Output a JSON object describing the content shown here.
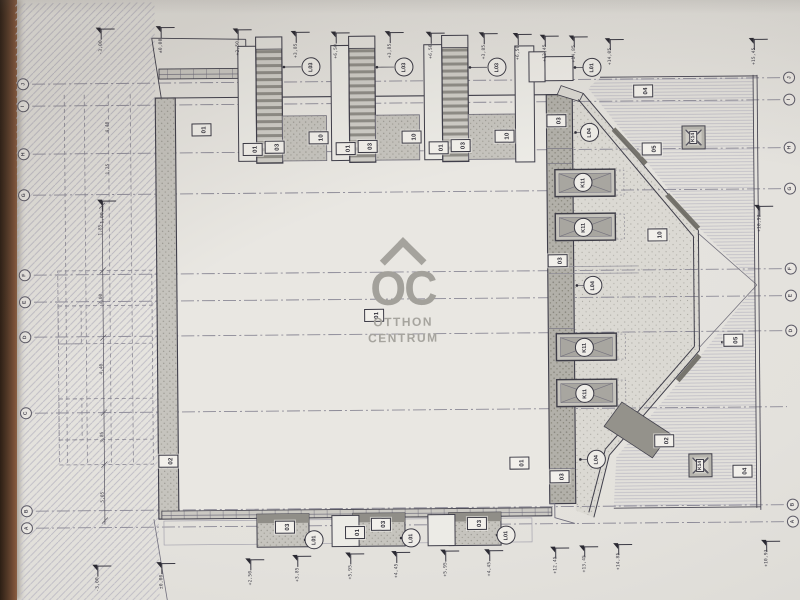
{
  "colors": {
    "paper": "#e3e1dc",
    "ink": "#3f3e4a",
    "ink_light": "#8b8996",
    "watermark": "#a3a19b",
    "table_edge": "#4a3323"
  },
  "watermark": {
    "logo": "OC",
    "line1": "OTTHON",
    "line2": "CENTRUM"
  },
  "plan_labels": [
    {
      "k": "bub",
      "t": "J",
      "x": 25,
      "y": 81
    },
    {
      "k": "bub",
      "t": "I",
      "x": 25,
      "y": 103
    },
    {
      "k": "bub",
      "t": "H",
      "x": 25,
      "y": 151
    },
    {
      "k": "bub",
      "t": "G",
      "x": 25,
      "y": 192
    },
    {
      "k": "bub",
      "t": "F",
      "x": 25,
      "y": 272
    },
    {
      "k": "bub",
      "t": "E",
      "x": 25,
      "y": 299
    },
    {
      "k": "bub",
      "t": "D",
      "x": 25,
      "y": 334
    },
    {
      "k": "bub",
      "t": "C",
      "x": 25,
      "y": 410
    },
    {
      "k": "bub",
      "t": "B",
      "x": 25,
      "y": 508
    },
    {
      "k": "bub",
      "t": "A",
      "x": 25,
      "y": 525
    },
    {
      "k": "bub",
      "t": "J",
      "x": 791,
      "y": 81
    },
    {
      "k": "bub",
      "t": "I",
      "x": 791,
      "y": 103
    },
    {
      "k": "bub",
      "t": "H",
      "x": 791,
      "y": 151
    },
    {
      "k": "bub",
      "t": "G",
      "x": 791,
      "y": 192
    },
    {
      "k": "bub",
      "t": "F",
      "x": 791,
      "y": 272
    },
    {
      "k": "bub",
      "t": "E",
      "x": 791,
      "y": 299
    },
    {
      "k": "bub",
      "t": "D",
      "x": 791,
      "y": 334
    },
    {
      "k": "bub",
      "t": "B",
      "x": 791,
      "y": 508
    },
    {
      "k": "bub",
      "t": "A",
      "x": 791,
      "y": 525
    },
    {
      "k": "box",
      "t": "01",
      "x": 203,
      "y": 128
    },
    {
      "k": "box",
      "t": "01",
      "x": 374,
      "y": 315
    },
    {
      "k": "box",
      "t": "01",
      "x": 518,
      "y": 464
    },
    {
      "k": "box",
      "t": "01",
      "x": 254,
      "y": 148
    },
    {
      "k": "box",
      "t": "01",
      "x": 347,
      "y": 148
    },
    {
      "k": "box",
      "t": "01",
      "x": 440,
      "y": 148
    },
    {
      "k": "box",
      "t": "01",
      "x": 353,
      "y": 532
    },
    {
      "k": "box",
      "t": "03",
      "x": 276,
      "y": 146
    },
    {
      "k": "box",
      "t": "03",
      "x": 369,
      "y": 146
    },
    {
      "k": "box",
      "t": "03",
      "x": 462,
      "y": 146
    },
    {
      "k": "box",
      "t": "03",
      "x": 558,
      "y": 122
    },
    {
      "k": "box",
      "t": "03",
      "x": 558,
      "y": 262
    },
    {
      "k": "box",
      "t": "03",
      "x": 558,
      "y": 478
    },
    {
      "k": "box",
      "t": "03",
      "x": 283,
      "y": 526
    },
    {
      "k": "box",
      "t": "03",
      "x": 379,
      "y": 524
    },
    {
      "k": "box",
      "t": "03",
      "x": 475,
      "y": 524
    },
    {
      "k": "box",
      "t": "10",
      "x": 320,
      "y": 137
    },
    {
      "k": "box",
      "t": "10",
      "x": 413,
      "y": 137
    },
    {
      "k": "box",
      "t": "10",
      "x": 506,
      "y": 137
    },
    {
      "k": "box",
      "t": "10",
      "x": 658,
      "y": 237
    },
    {
      "k": "box",
      "t": "04",
      "x": 645,
      "y": 93
    },
    {
      "k": "box",
      "t": "04",
      "x": 741,
      "y": 474
    },
    {
      "k": "box",
      "t": "05",
      "x": 653,
      "y": 151
    },
    {
      "k": "box",
      "t": "05",
      "x": 733,
      "y": 343
    },
    {
      "k": "box",
      "t": "02",
      "x": 167,
      "y": 459
    },
    {
      "k": "box",
      "t": "02",
      "x": 663,
      "y": 443
    },
    {
      "k": "circ",
      "t": "L03",
      "x": 313,
      "y": 66
    },
    {
      "k": "circ",
      "t": "L03",
      "x": 406,
      "y": 67
    },
    {
      "k": "circ",
      "t": "L03",
      "x": 499,
      "y": 68
    },
    {
      "k": "circ",
      "t": "L01",
      "x": 594,
      "y": 69
    },
    {
      "k": "circ",
      "t": "L01",
      "x": 312,
      "y": 539
    },
    {
      "k": "circ",
      "t": "L01",
      "x": 409,
      "y": 538
    },
    {
      "k": "circ",
      "t": "L01",
      "x": 504,
      "y": 536
    },
    {
      "k": "circ",
      "t": "L04",
      "x": 591,
      "y": 134
    },
    {
      "k": "circ",
      "t": "L04",
      "x": 593,
      "y": 287
    },
    {
      "k": "circ",
      "t": "L04",
      "x": 595,
      "y": 461
    },
    {
      "k": "circ",
      "t": "K11",
      "x": 584,
      "y": 184
    },
    {
      "k": "circ",
      "t": "K11",
      "x": 584,
      "y": 229
    },
    {
      "k": "circ",
      "t": "K11",
      "x": 584,
      "y": 349
    },
    {
      "k": "circ",
      "t": "K11",
      "x": 584,
      "y": 395
    },
    {
      "k": "k14",
      "t": "K14",
      "x": 695,
      "y": 140
    },
    {
      "k": "k14",
      "t": "K14",
      "x": 699,
      "y": 468
    },
    {
      "k": "flag",
      "t": "-3,00",
      "x": 103,
      "y": 26
    },
    {
      "k": "flag",
      "t": "±0,00",
      "x": 163,
      "y": 25
    },
    {
      "k": "flag",
      "t": "+2,50",
      "x": 240,
      "y": 28
    },
    {
      "k": "flag",
      "t": "+3,85",
      "x": 298,
      "y": 31
    },
    {
      "k": "flag",
      "t": "+6,50",
      "x": 338,
      "y": 32
    },
    {
      "k": "flag",
      "t": "+3,85",
      "x": 392,
      "y": 32
    },
    {
      "k": "flag",
      "t": "+6,50",
      "x": 433,
      "y": 33
    },
    {
      "k": "flag",
      "t": "+3,85",
      "x": 486,
      "y": 34
    },
    {
      "k": "flag",
      "t": "+6,50",
      "x": 520,
      "y": 35
    },
    {
      "k": "flag",
      "t": "+12,45",
      "x": 547,
      "y": 37
    },
    {
      "k": "flag",
      "t": "+14,85",
      "x": 576,
      "y": 38
    },
    {
      "k": "flag",
      "t": "+14,05",
      "x": 612,
      "y": 41
    },
    {
      "k": "flag",
      "t": "+15,45",
      "x": 756,
      "y": 42
    },
    {
      "k": "flag",
      "t": "+10,93",
      "x": 760,
      "y": 209
    },
    {
      "k": "flag",
      "t": "-1,00",
      "x": 103,
      "y": 198
    },
    {
      "k": "flag",
      "t": "-3,00",
      "x": 95,
      "y": 563
    },
    {
      "k": "flag",
      "t": "±0,00",
      "x": 159,
      "y": 561
    },
    {
      "k": "flag",
      "t": "+2,50",
      "x": 248,
      "y": 558
    },
    {
      "k": "flag",
      "t": "+3,85",
      "x": 295,
      "y": 555
    },
    {
      "k": "flag",
      "t": "+5,95",
      "x": 348,
      "y": 553
    },
    {
      "k": "flag",
      "t": "+4,45",
      "x": 394,
      "y": 552
    },
    {
      "k": "flag",
      "t": "+5,95",
      "x": 443,
      "y": 551
    },
    {
      "k": "flag",
      "t": "+4,45",
      "x": 487,
      "y": 551
    },
    {
      "k": "flag",
      "t": "+12,45",
      "x": 553,
      "y": 549
    },
    {
      "k": "flag",
      "t": "+13,45",
      "x": 582,
      "y": 548
    },
    {
      "k": "flag",
      "t": "+14,85",
      "x": 616,
      "y": 546
    },
    {
      "k": "flag",
      "t": "+10,93",
      "x": 764,
      "y": 544
    },
    {
      "k": "dim",
      "t": "4,40",
      "x": 107,
      "y": 130
    },
    {
      "k": "dim",
      "t": "1,25",
      "x": 107,
      "y": 172
    },
    {
      "k": "dim",
      "t": "1,85",
      "x": 99,
      "y": 233
    },
    {
      "k": "dim",
      "t": "3,00",
      "x": 99,
      "y": 302
    },
    {
      "k": "dim",
      "t": "4,40",
      "x": 99,
      "y": 372
    },
    {
      "k": "dim",
      "t": "3,85",
      "x": 99,
      "y": 440
    },
    {
      "k": "dim",
      "t": "5,05",
      "x": 99,
      "y": 500
    }
  ]
}
